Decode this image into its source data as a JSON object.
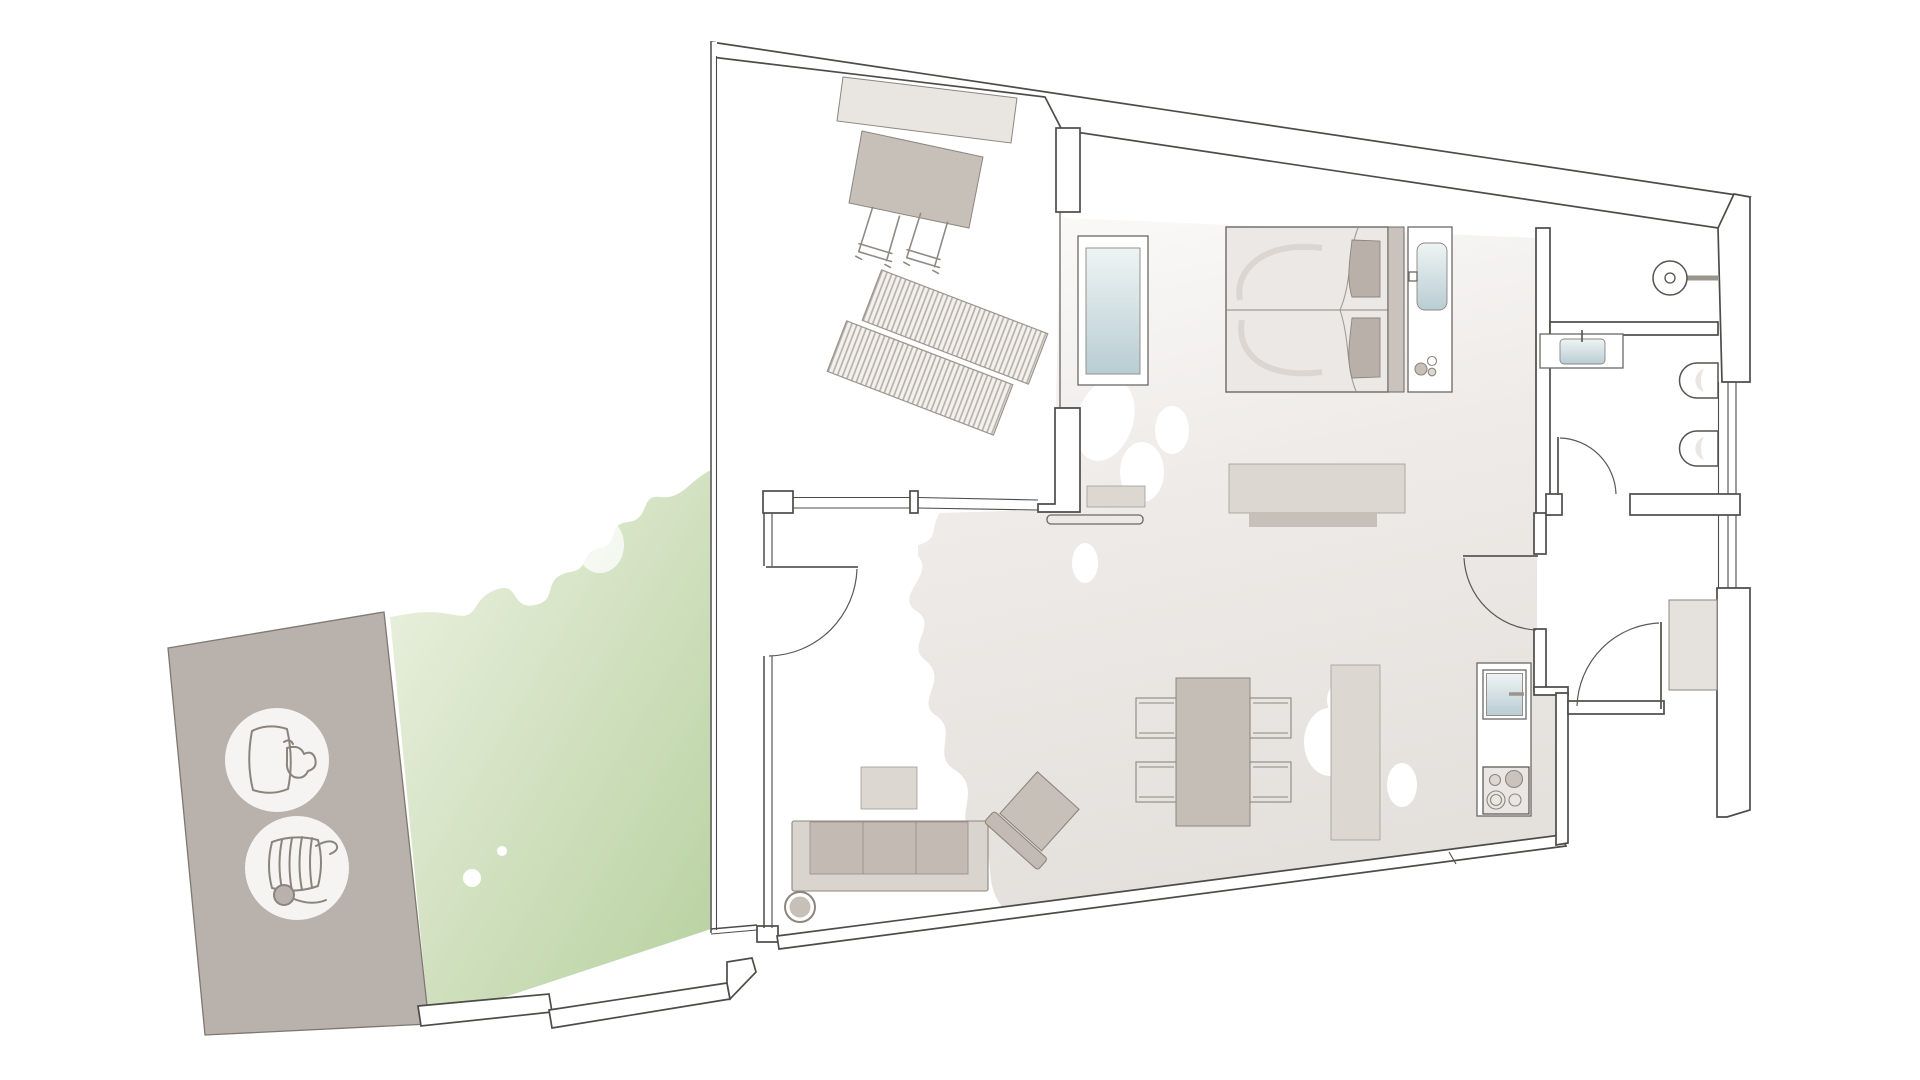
{
  "title": "apartment-floor-plan",
  "colors": {
    "wall_outline": "#4e4c49",
    "furniture_outline": "#8d867f",
    "awning": "#e9e6e2",
    "outdoor_table": "#c7c0b9",
    "lounger_stripe": "#b5ada5",
    "lounger_base": "#f3f1ee",
    "floor_light": "#fcfbfa",
    "floor_dark": "#e4e1dd",
    "mattress": "#ebe8e5",
    "pillow": "#b8b0a9",
    "headboard": "#cac3bd",
    "glass_light": "#eef4f4",
    "glass_dark": "#b9cdd3",
    "sofa_base": "#dad4ce",
    "sofa_cushion": "#c2bab3",
    "table_gray": "#c5beb7",
    "cabinet_light": "#dcd7d1",
    "shadow_gray": "#c7c0b9",
    "stove_body": "#e9e6e3",
    "closet": "#e5e1dd",
    "patio": "#b9b1ab",
    "icon_circle": "#f5f4f2",
    "garden_light": "#eef3e4",
    "garden_dark": "#b6d09e"
  },
  "rooms": [
    {
      "id": "terrace"
    },
    {
      "id": "garden"
    },
    {
      "id": "patio"
    },
    {
      "id": "bedroom"
    },
    {
      "id": "living-room"
    },
    {
      "id": "kitchen"
    },
    {
      "id": "bathroom"
    },
    {
      "id": "wc"
    },
    {
      "id": "hallway"
    }
  ],
  "furniture": [
    {
      "id": "awning"
    },
    {
      "id": "outdoor-table"
    },
    {
      "id": "outdoor-chair",
      "count": 2
    },
    {
      "id": "sun-lounger",
      "count": 2
    },
    {
      "id": "double-bed"
    },
    {
      "id": "bedside-console"
    },
    {
      "id": "glass-panel"
    },
    {
      "id": "wall-shelf"
    },
    {
      "id": "tv-lowboard"
    },
    {
      "id": "dining-table"
    },
    {
      "id": "dining-chair",
      "count": 4
    },
    {
      "id": "sideboard"
    },
    {
      "id": "sofa"
    },
    {
      "id": "coffee-table"
    },
    {
      "id": "floor-lamp"
    },
    {
      "id": "armchair"
    },
    {
      "id": "kitchen-counter"
    },
    {
      "id": "kitchen-sink"
    },
    {
      "id": "stove"
    },
    {
      "id": "vanity"
    },
    {
      "id": "washbasin"
    },
    {
      "id": "toilet",
      "count": 2
    },
    {
      "id": "round-basin"
    },
    {
      "id": "entry-closet"
    }
  ],
  "amenity_icons": [
    {
      "id": "grill-icon"
    },
    {
      "id": "sun-lounger-icon"
    }
  ],
  "doors": [
    {
      "id": "terrace-door"
    },
    {
      "id": "bathroom-door"
    },
    {
      "id": "living-hall-door"
    },
    {
      "id": "entry-door"
    }
  ]
}
